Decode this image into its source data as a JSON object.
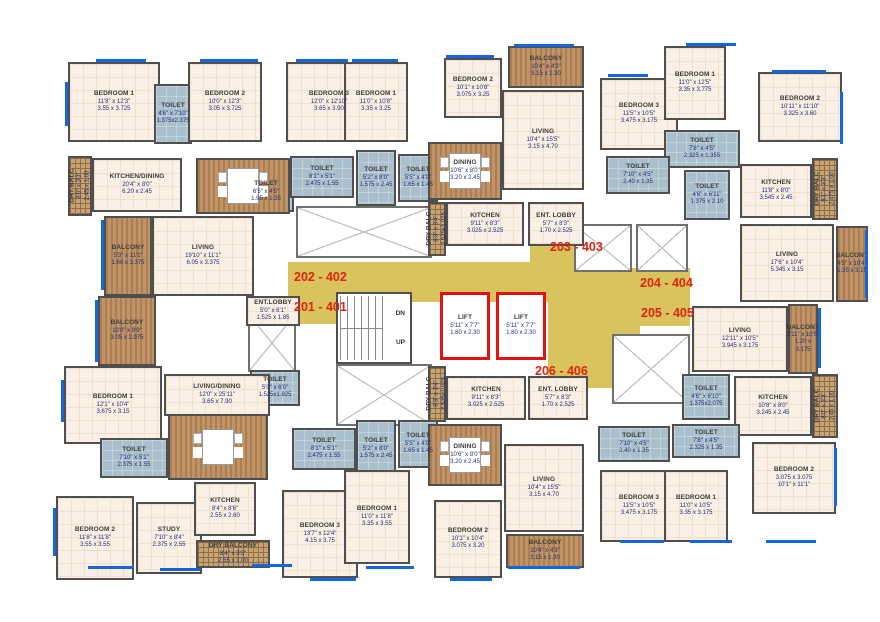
{
  "plan": {
    "colors": {
      "corridor": "#d9c35c",
      "lift_wall": "#e01212",
      "unit_number_red": "#e02312",
      "toilet_fill": "#a9bfcb",
      "wood_fill": "#b98e61",
      "wall": "#4f4f4f",
      "window_blue": "#1565dd",
      "floor_cream": "#f9efe4",
      "dim_text_navy": "#222e7a",
      "name_text": "#3c3c3c"
    },
    "unit_labels": [
      {
        "text": "201 - 401",
        "x": 294,
        "y": 300
      },
      {
        "text": "202 - 402",
        "x": 294,
        "y": 270
      },
      {
        "text": "203 - 403",
        "x": 550,
        "y": 240
      },
      {
        "text": "204 - 404",
        "x": 640,
        "y": 276
      },
      {
        "text": "205 - 405",
        "x": 641,
        "y": 306
      },
      {
        "text": "206 - 406",
        "x": 535,
        "y": 364
      }
    ],
    "corridor_segments": [
      [
        288,
        262,
        314,
        40
      ],
      [
        530,
        234,
        72,
        28
      ],
      [
        600,
        268,
        90,
        58
      ],
      [
        548,
        302,
        54,
        86
      ],
      [
        600,
        326,
        40,
        62
      ],
      [
        288,
        296,
        54,
        28
      ]
    ],
    "stairs": {
      "box": [
        336,
        292,
        76,
        72
      ],
      "down_label": "DN",
      "up_label": "UP"
    },
    "lifts": [
      {
        "name": "LIFT",
        "ft": "5'11\" x 7'7\"",
        "m": "1.80 x 2.30",
        "x": 440,
        "y": 292,
        "w": 50,
        "h": 68
      },
      {
        "name": "LIFT",
        "ft": "5'11\" x 7'7\"",
        "m": "1.80 x 2.30",
        "x": 496,
        "y": 292,
        "w": 50,
        "h": 68
      }
    ],
    "shafts": [
      [
        296,
        206,
        136,
        52
      ],
      [
        248,
        314,
        48,
        58
      ],
      [
        574,
        224,
        58,
        48
      ],
      [
        636,
        224,
        52,
        48
      ],
      [
        612,
        334,
        78,
        70
      ],
      [
        336,
        364,
        96,
        62
      ]
    ],
    "rooms": [
      {
        "name": "BEDROOM 1",
        "ft": "11'8\" x 12'3\"",
        "m": "3.55 x 3.725",
        "type": "room",
        "box": [
          68,
          62,
          92,
          80
        ]
      },
      {
        "name": "TOILET",
        "ft": "4'6\" x 7'10\"",
        "m": "1.375x2.375",
        "type": "toilet",
        "box": [
          154,
          84,
          38,
          60
        ]
      },
      {
        "name": "BEDROOM 2",
        "ft": "10'0\" x 12'3\"",
        "m": "3.05 x 3.725",
        "type": "room",
        "box": [
          188,
          62,
          74,
          80
        ]
      },
      {
        "name": "DRY BALC",
        "ft": "8'0\" x 3'3\"",
        "m": "2.45 x 1.00",
        "type": "drybalc",
        "box": [
          68,
          156,
          24,
          60
        ],
        "vert": true
      },
      {
        "name": "KITCHEN/DINING",
        "ft": "20'4\" x 8'0\"",
        "m": "6.20 x 2.45",
        "type": "room",
        "box": [
          92,
          158,
          90,
          54
        ]
      },
      {
        "name": "TOILET",
        "ft": "6'5\" x 4'5\"",
        "m": "1.95 x 1.35",
        "type": "toilet",
        "box": [
          238,
          172,
          56,
          40
        ]
      },
      {
        "name": "BALCONY",
        "ft": "5'3\" x 11'1\"",
        "m": "1.60 x 3.375",
        "type": "balcony",
        "box": [
          104,
          216,
          48,
          80
        ]
      },
      {
        "name": "LIVING",
        "ft": "19'10\" x 11'1\"",
        "m": "6.05 x 3.375",
        "type": "room",
        "box": [
          152,
          216,
          102,
          80
        ]
      },
      {
        "name": "BEDROOM 3",
        "ft": "12'0\" x 12'10\"",
        "m": "3.65 x 3.90",
        "type": "room",
        "box": [
          286,
          62,
          86,
          80
        ]
      },
      {
        "name": "BEDROOM 1",
        "ft": "11'0\" x 10'8\"",
        "m": "3.35 x 3.25",
        "type": "room",
        "box": [
          344,
          62,
          64,
          80
        ]
      },
      {
        "name": "TOILET",
        "ft": "8'1\" x 5'1\"",
        "m": "2.475 x 1.55",
        "type": "toilet",
        "box": [
          290,
          156,
          64,
          42
        ]
      },
      {
        "name": "TOILET",
        "ft": "5'2\" x 8'0\"",
        "m": "1.575 x 2.45",
        "type": "toilet",
        "box": [
          356,
          150,
          40,
          56
        ]
      },
      {
        "name": "TOILET",
        "ft": "5'5\" x 4'9\"",
        "m": "1.65 x 1.45",
        "type": "toilet",
        "box": [
          398,
          154,
          40,
          48
        ]
      },
      {
        "name": "BEDROOM 2",
        "ft": "10'1\" x 10'8\"",
        "m": "3.075 x 3.25",
        "type": "room",
        "box": [
          444,
          58,
          58,
          60
        ]
      },
      {
        "name": "DINING",
        "ft": "10'6\" x 8'0\"",
        "m": "3.20 x 2.45",
        "type": "dining",
        "box": [
          428,
          142,
          74,
          58
        ]
      },
      {
        "name": "BALCONY",
        "ft": "10'4\" x 4'3\"",
        "m": "3.15 x 1.30",
        "type": "balcony",
        "box": [
          508,
          46,
          76,
          42
        ]
      },
      {
        "name": "LIVING",
        "ft": "10'4\" x 15'5\"",
        "m": "3.15 x 4.70",
        "type": "room",
        "box": [
          502,
          90,
          82,
          100
        ]
      },
      {
        "name": "KITCHEN",
        "ft": "9'11\" x 8'3\"",
        "m": "3.025 x 2.525",
        "type": "room",
        "box": [
          446,
          202,
          78,
          44
        ]
      },
      {
        "name": "ENT. LOBBY",
        "ft": "5'7\" x 8'3\"",
        "m": "1.70 x 2.525",
        "type": "room",
        "box": [
          528,
          202,
          56,
          44
        ]
      },
      {
        "name": "DRY BALC",
        "ft": "8'3\" x 3'4\"",
        "m": "2.525x1.025",
        "type": "drybalc",
        "box": [
          428,
          202,
          18,
          54
        ],
        "vert": true
      },
      {
        "name": "BEDROOM 3",
        "ft": "11'5\" x 10'5\"",
        "m": "3.475 x 3.175",
        "type": "room",
        "box": [
          600,
          78,
          78,
          72
        ]
      },
      {
        "name": "BEDROOM 1",
        "ft": "11'0\" x 12'5\"",
        "m": "3.35 x 3.775",
        "type": "room",
        "box": [
          664,
          46,
          62,
          74
        ]
      },
      {
        "name": "BEDROOM 2",
        "ft": "10'11\" x 11'10\"",
        "m": "3.325 x 3.60",
        "type": "room",
        "box": [
          758,
          72,
          84,
          70
        ]
      },
      {
        "name": "TOILET",
        "ft": "7'8\" x 4'5\"",
        "m": "2.325 x 1.355",
        "type": "toilet",
        "box": [
          664,
          130,
          76,
          38
        ]
      },
      {
        "name": "TOILET",
        "ft": "7'10\" x 4'5\"",
        "m": "2.40 x 1.35",
        "type": "toilet",
        "box": [
          606,
          156,
          64,
          38
        ]
      },
      {
        "name": "TOILET",
        "ft": "4'6\" x 6'11\"",
        "m": "1.375 x 2.10",
        "type": "toilet",
        "box": [
          684,
          170,
          46,
          50
        ]
      },
      {
        "name": "KITCHEN",
        "ft": "11'8\" x 8'0\"",
        "m": "3.545 x 2.45",
        "type": "room",
        "box": [
          740,
          164,
          72,
          54
        ]
      },
      {
        "name": "DRY BALC",
        "ft": "8'1\" x 3'3\"",
        "m": "2.475 x 1.00",
        "type": "drybalc",
        "box": [
          812,
          158,
          26,
          62
        ],
        "vert": true
      },
      {
        "name": "LIVING",
        "ft": "17'6\" x 10'4\"",
        "m": "5.345 x 3.15",
        "type": "room",
        "box": [
          740,
          224,
          94,
          78
        ]
      },
      {
        "name": "BALCONY",
        "ft": "4'5\" x 10'4\"",
        "m": "1.35 x 3.15",
        "type": "balcony",
        "box": [
          836,
          226,
          32,
          76
        ]
      },
      {
        "name": "BALCONY",
        "ft": "10'0\" x 9'9\"",
        "m": "3.05 x 2.975",
        "type": "balcony",
        "box": [
          98,
          296,
          58,
          70
        ]
      },
      {
        "name": "ENT.LOBBY",
        "ft": "5'0\" x 6'1\"",
        "m": "1.525 x 1.85",
        "type": "room",
        "box": [
          246,
          296,
          54,
          30
        ]
      },
      {
        "name": "TOILET",
        "ft": "5'0\" x 6'0\"",
        "m": "1.525x1.825",
        "type": "toilet",
        "box": [
          250,
          370,
          50,
          36
        ]
      },
      {
        "name": "BEDROOM 1",
        "ft": "12'1\" x 10'4\"",
        "m": "3.675 x 3.15",
        "type": "room",
        "box": [
          64,
          366,
          98,
          78
        ]
      },
      {
        "name": "LIVING/DINING",
        "ft": "12'0\" x 25'11\"",
        "m": "3.65 x 7.90",
        "type": "room",
        "box": [
          164,
          374,
          106,
          42
        ]
      },
      {
        "name": "TOILET",
        "ft": "7'10\" x 5'1\"",
        "m": "2.375 x 1.55",
        "type": "toilet",
        "box": [
          100,
          438,
          68,
          40
        ]
      },
      {
        "name": "BEDROOM 2",
        "ft": "11'8\" x 11'8\"",
        "m": "3.55 x 3.55",
        "type": "room",
        "box": [
          56,
          496,
          78,
          84
        ]
      },
      {
        "name": "STUDY",
        "ft": "7'10\" x 8'4\"",
        "m": "2.375 x 2.55",
        "type": "room",
        "box": [
          136,
          502,
          66,
          72
        ]
      },
      {
        "name": "KITCHEN",
        "ft": "8'4\" x 8'6\"",
        "m": "2.55 x 2.60",
        "type": "room",
        "box": [
          194,
          482,
          62,
          54
        ]
      },
      {
        "name": "DRY BALCONY",
        "ft": "8'4\" x 3'3\"",
        "m": "2.55 x 1.00",
        "type": "drybalc",
        "box": [
          196,
          540,
          74,
          28
        ]
      },
      {
        "name": "TOILET",
        "ft": "8'1\" x 5'1\"",
        "m": "2.475 x 1.55",
        "type": "toilet",
        "box": [
          292,
          428,
          64,
          42
        ]
      },
      {
        "name": "TOILET",
        "ft": "5'2\" x 8'0\"",
        "m": "1.575 x 2.45",
        "type": "toilet",
        "box": [
          356,
          420,
          40,
          58
        ]
      },
      {
        "name": "TOILET",
        "ft": "5'5\" x 4'9\"",
        "m": "1.65 x 1.45",
        "type": "toilet",
        "box": [
          398,
          420,
          40,
          48
        ]
      },
      {
        "name": "DINING",
        "ft": "10'6\" x 8'0\"",
        "m": "3.20 x 2.45",
        "type": "dining",
        "box": [
          428,
          424,
          74,
          62
        ]
      },
      {
        "name": "KITCHEN",
        "ft": "9'11\" x 8'3\"",
        "m": "3.025 x 2.525",
        "type": "room",
        "box": [
          446,
          376,
          80,
          44
        ]
      },
      {
        "name": "ENT. LOBBY",
        "ft": "5'7\" x 8'3\"",
        "m": "1.70 x 2.525",
        "type": "room",
        "box": [
          528,
          376,
          60,
          44
        ]
      },
      {
        "name": "DRY BALC",
        "ft": "8'3\" x 3'4\"",
        "m": "2.525x1.025",
        "type": "drybalc",
        "box": [
          428,
          366,
          18,
          56
        ],
        "vert": true
      },
      {
        "name": "BEDROOM 3",
        "ft": "13'7\" x 12'4\"",
        "m": "4.15 x 3.75",
        "type": "room",
        "box": [
          282,
          490,
          76,
          88
        ]
      },
      {
        "name": "BEDROOM 1",
        "ft": "11'0\" x 11'8\"",
        "m": "3.35 x 3.55",
        "type": "room",
        "box": [
          344,
          470,
          66,
          94
        ]
      },
      {
        "name": "BEDROOM 2",
        "ft": "10'1\" x 10'4\"",
        "m": "3.075 x 3.20",
        "type": "room",
        "box": [
          434,
          500,
          68,
          78
        ]
      },
      {
        "name": "LIVING",
        "ft": "10'4\" x 15'5\"",
        "m": "3.15 x 4.70",
        "type": "room",
        "box": [
          504,
          444,
          80,
          88
        ]
      },
      {
        "name": "BALCONY",
        "ft": "10'4\" x 4'3\"",
        "m": "3.15 x 1.30",
        "type": "balcony",
        "box": [
          506,
          534,
          78,
          34
        ]
      },
      {
        "name": "TOILET",
        "ft": "4'6\" x 6'10\"",
        "m": "1.375x2.075",
        "type": "toilet",
        "box": [
          682,
          374,
          48,
          46
        ]
      },
      {
        "name": "KITCHEN",
        "ft": "10'8\" x 8'0\"",
        "m": "3.245 x 2.45",
        "type": "room",
        "box": [
          734,
          376,
          78,
          60
        ]
      },
      {
        "name": "DRY BALC",
        "ft": "8'0\" x 3'3\"",
        "m": "2.45 x 1.00",
        "type": "drybalc",
        "box": [
          812,
          374,
          26,
          64
        ],
        "vert": true
      },
      {
        "name": "LIVING",
        "ft": "12'11\" x 10'5\"",
        "m": "3.945 x 3.175",
        "type": "room",
        "box": [
          692,
          306,
          96,
          66
        ]
      },
      {
        "name": "BALCONY",
        "ft": "3'11\" x 10'5\"",
        "m": "1.20 x 3.175",
        "type": "balcony",
        "box": [
          788,
          304,
          30,
          70
        ]
      },
      {
        "name": "TOILET",
        "ft": "7'10\" x 4'5\"",
        "m": "2.40 x 1.35",
        "type": "toilet",
        "box": [
          598,
          426,
          72,
          36
        ]
      },
      {
        "name": "TOILET",
        "ft": "7'8\" x 4'5\"",
        "m": "2.325 x 1.35",
        "type": "toilet",
        "box": [
          672,
          424,
          68,
          34
        ]
      },
      {
        "name": "BEDROOM 3",
        "ft": "11'5\" x 10'5\"",
        "m": "3.475 x 3.175",
        "type": "room",
        "box": [
          600,
          470,
          78,
          72
        ]
      },
      {
        "name": "BEDROOM 1",
        "ft": "11'0\" x 10'5\"",
        "m": "3.35 x 3.175",
        "type": "room",
        "box": [
          664,
          470,
          64,
          72
        ]
      },
      {
        "name": "BEDROOM 2",
        "ft": "3.075 x 3.075",
        "m": "10'1\" x 11'1\"",
        "type": "room",
        "box": [
          752,
          442,
          84,
          72
        ]
      },
      {
        "name": "",
        "ft": "",
        "m": "",
        "type": "dining",
        "box": [
          196,
          158,
          94,
          56
        ]
      },
      {
        "name": "",
        "ft": "",
        "m": "",
        "type": "dining",
        "box": [
          168,
          414,
          100,
          66
        ]
      }
    ],
    "windows": [
      [
        96,
        59,
        50,
        3
      ],
      [
        200,
        59,
        58,
        3
      ],
      [
        296,
        59,
        52,
        3
      ],
      [
        352,
        59,
        46,
        3
      ],
      [
        446,
        55,
        48,
        3
      ],
      [
        514,
        44,
        60,
        3
      ],
      [
        686,
        43,
        50,
        3
      ],
      [
        772,
        70,
        54,
        3
      ],
      [
        608,
        74,
        40,
        3
      ],
      [
        65,
        82,
        3,
        44
      ],
      [
        101,
        220,
        3,
        70
      ],
      [
        95,
        300,
        3,
        62
      ],
      [
        61,
        380,
        3,
        42
      ],
      [
        53,
        508,
        3,
        48
      ],
      [
        840,
        92,
        3,
        52
      ],
      [
        865,
        230,
        3,
        68
      ],
      [
        818,
        308,
        3,
        60
      ],
      [
        834,
        448,
        3,
        58
      ],
      [
        88,
        566,
        46,
        3
      ],
      [
        160,
        568,
        40,
        3
      ],
      [
        252,
        564,
        40,
        3
      ],
      [
        310,
        578,
        46,
        3
      ],
      [
        366,
        566,
        48,
        3
      ],
      [
        450,
        578,
        42,
        3
      ],
      [
        508,
        566,
        72,
        3
      ],
      [
        620,
        540,
        44,
        3
      ],
      [
        690,
        540,
        42,
        3
      ],
      [
        766,
        540,
        50,
        3
      ]
    ]
  }
}
